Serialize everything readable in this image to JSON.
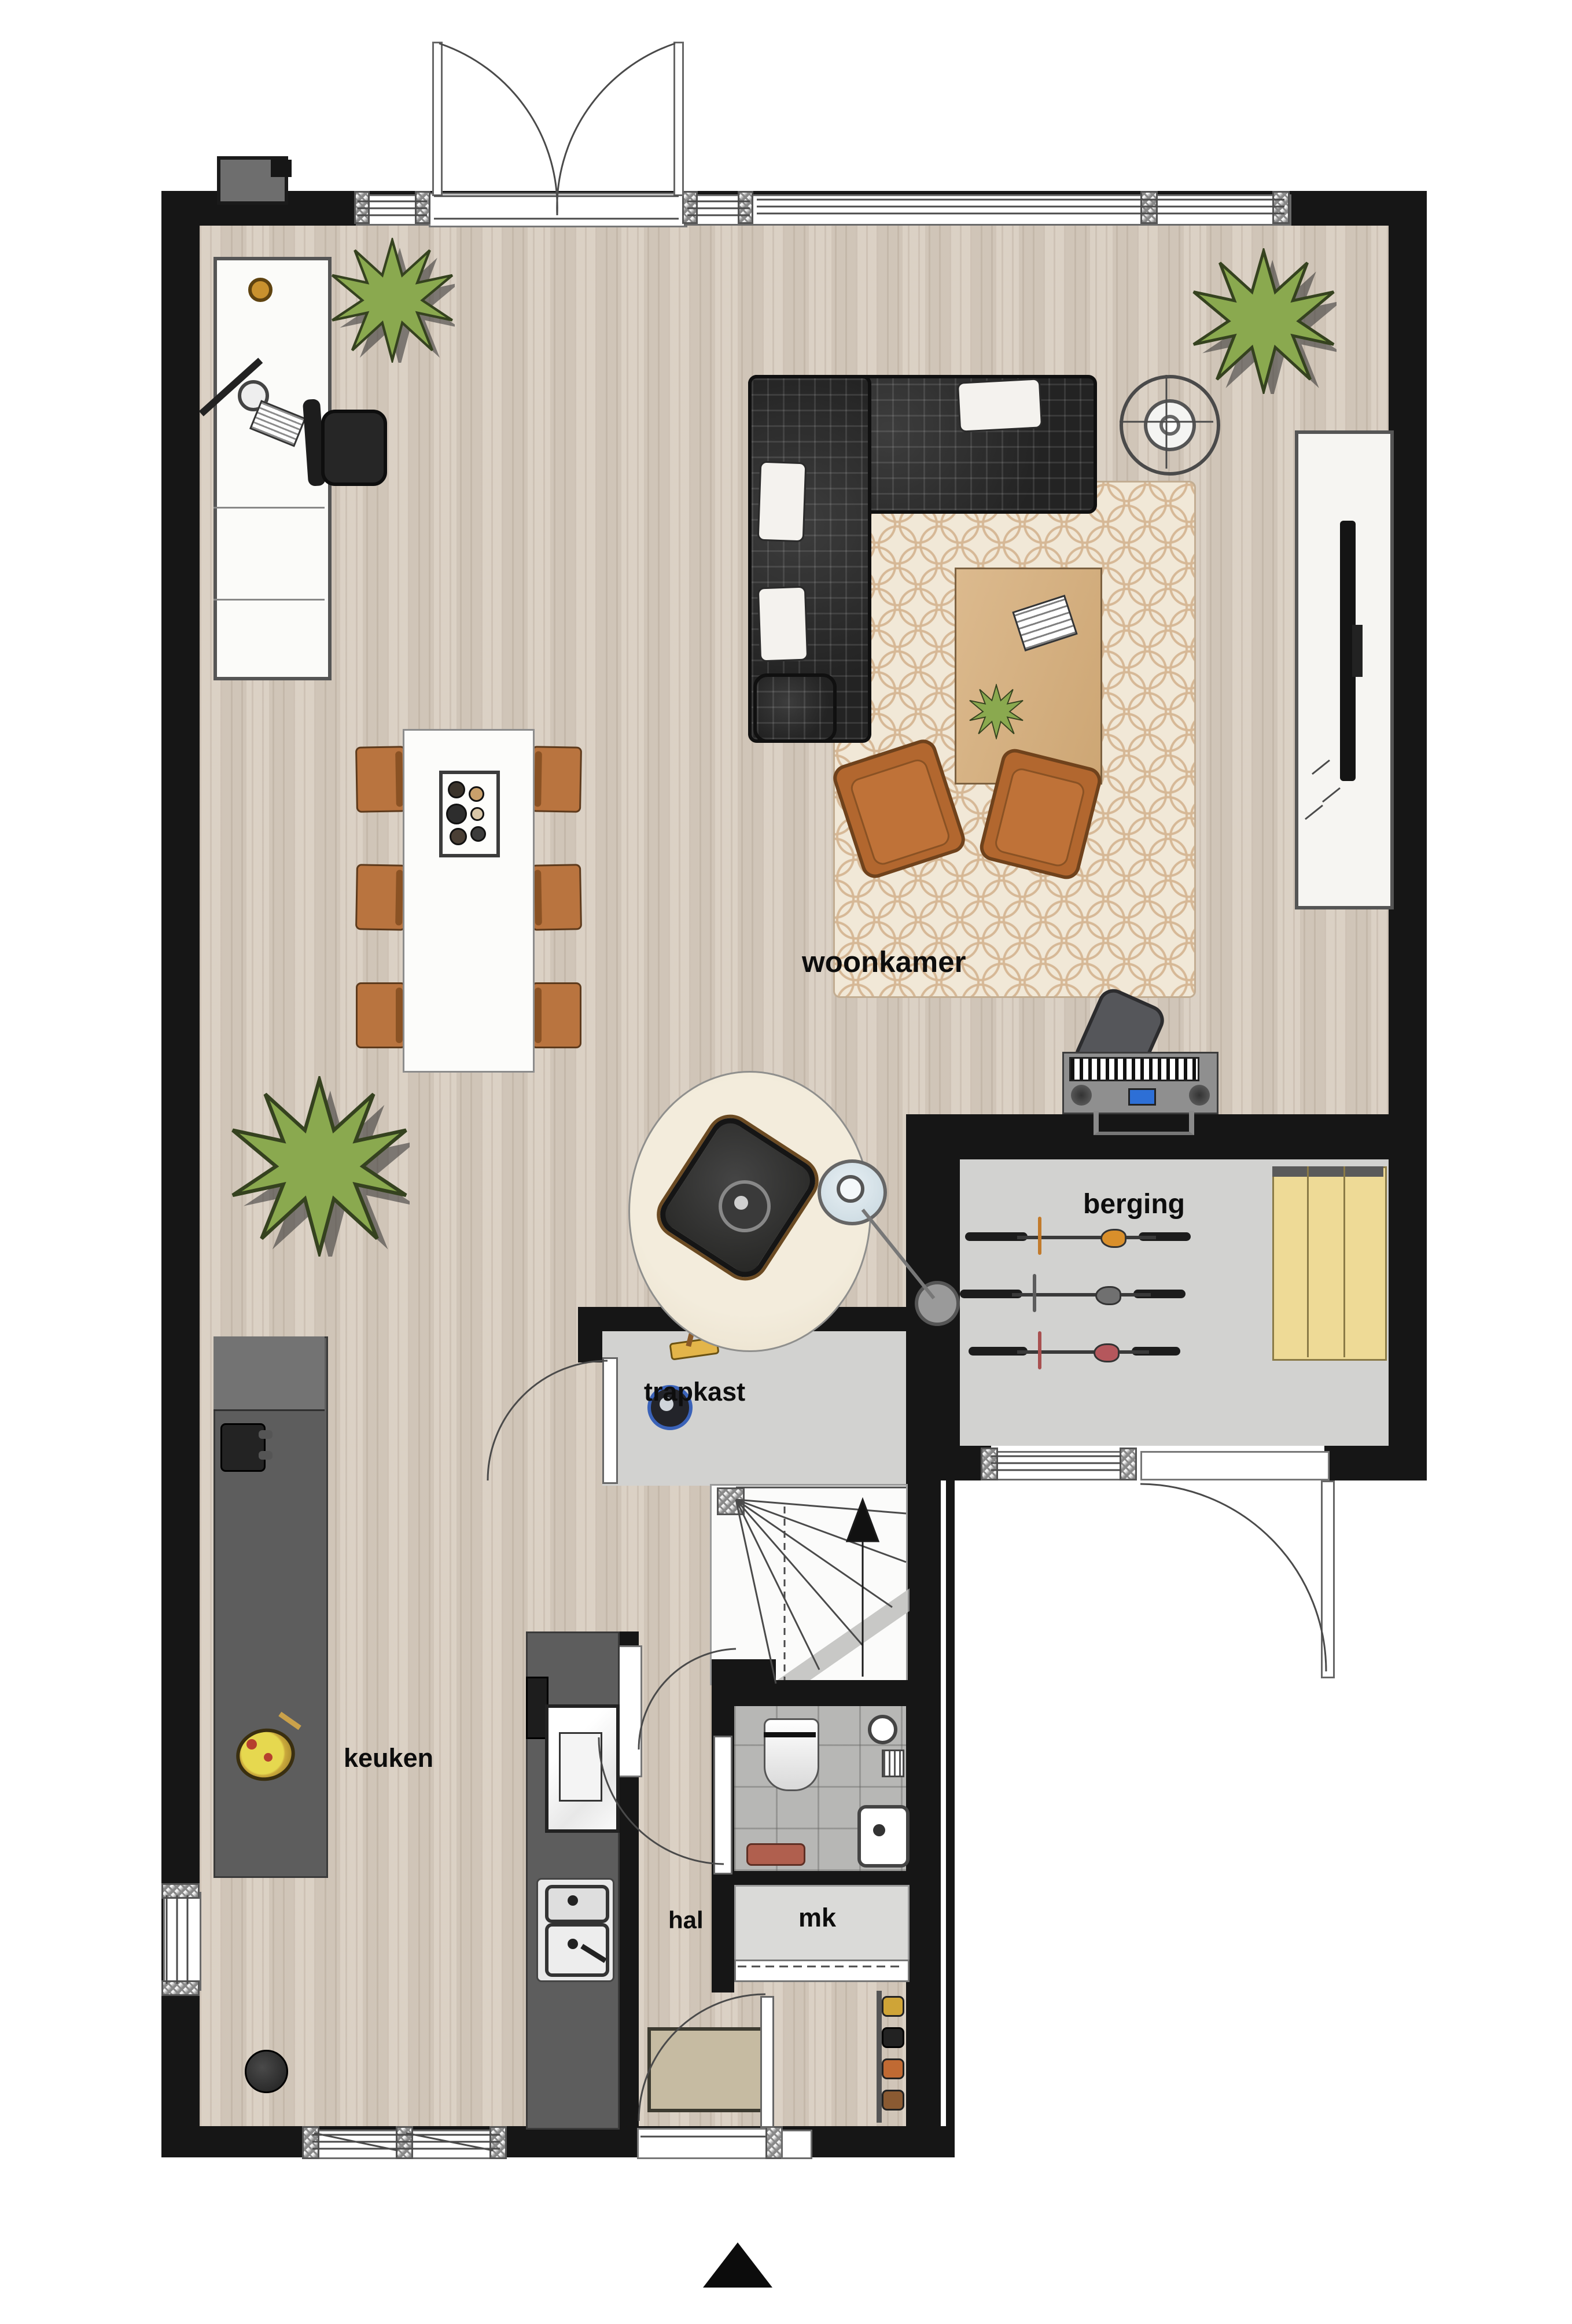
{
  "labels": {
    "living_room": "woonkamer",
    "storage": "berging",
    "stair_closet": "trapkast",
    "kitchen": "keuken",
    "hall": "hal",
    "meter_cupboard": "mk"
  },
  "icons": {
    "north-arrow": "▲"
  },
  "colors": {
    "wall": "#161616",
    "wood_floor": "#d9cec1",
    "storage_floor": "#d2d2d0",
    "tile_floor": "#b7b7b5",
    "rug": "#f1e8d7",
    "round_rug": "#efe7d6",
    "sofa": "#2b2b2b",
    "armchair_orange": "#b2672f",
    "dining_chair_orange": "#b9743f",
    "cabinet_yellow": "#eeda96",
    "counter_gray": "#5d5d5d",
    "coffee_table_wood": "#d7b488",
    "bike_saddles": [
      "#d98f2b",
      "#707070",
      "#b5575c"
    ],
    "doormat": "#c6bba2",
    "label_text": "#0d0d0d"
  }
}
